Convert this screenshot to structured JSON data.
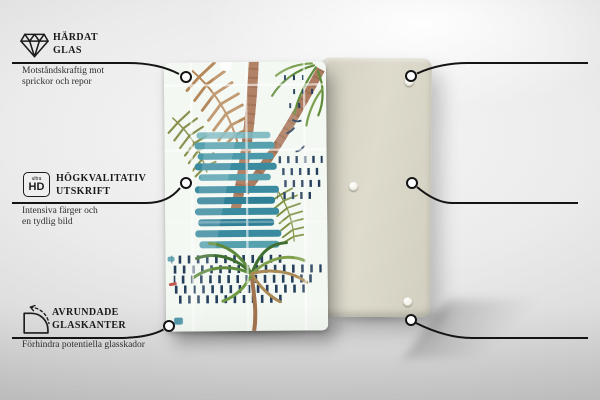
{
  "product": {
    "front_panel_art": "tropical-watercolor-palms",
    "back_panel_pads_visible": 3,
    "colors": {
      "teal_stripe": "#3a8ba0",
      "teal_stripe_light": "#79b7c0",
      "navy_dash": "#243e5c",
      "trunk_brown": "#ad7c60",
      "leaf_tan": "#b5885a",
      "leaf_olive": "#8a9150",
      "leaf_green": "#5f8b3a",
      "back_panel": "#d8d5c6",
      "callout_line": "#141414"
    }
  },
  "features": [
    {
      "id": "tempered-glass",
      "icon": "diamond-icon",
      "title_line1": "HÄRDAT",
      "title_line2": "GLAS",
      "desc_line1": "Motståndskraftig mot",
      "desc_line2": "sprickor och repor"
    },
    {
      "id": "non-slip-pads",
      "icon": "rubber-pad-arrow-icon",
      "title_line1": "HALKSÄKRA",
      "title_line2": "UNDERLÄGG",
      "desc_line1": "Självhäftande gummikuddar",
      "desc_line2": "ingår i uppsättningen"
    },
    {
      "id": "high-quality-print",
      "icon": "ultra-hd-icon",
      "title_line1": "HÖGKVALITATIV",
      "title_line2": "UTSKRIFT",
      "desc_line1": "Intensiva färger och",
      "desc_line2": "en tydlig bild"
    },
    {
      "id": "protective-film",
      "icon": "shield-check-icon",
      "title_line1": "SKYDDSFILM",
      "title_line2": "",
      "desc_line1": "Skyddar baksidan",
      "desc_line2": "av produkten"
    },
    {
      "id": "rounded-glass-edges",
      "icon": "rounded-corner-icon",
      "title_line1": "AVRUNDADE",
      "title_line2": "GLASKANTER",
      "desc_line1": "Förhindra potentiella glasskador",
      "desc_line2": ""
    },
    {
      "id": "ground-edges",
      "icon": "hatched-edge-icon",
      "title_line1": "SLIPADE",
      "title_line2": "KANTER",
      "desc_line1": "Slät och säker yta",
      "desc_line2": ""
    }
  ],
  "ultra_hd_icon": {
    "small_text": "ultra",
    "big_text": "HD"
  }
}
